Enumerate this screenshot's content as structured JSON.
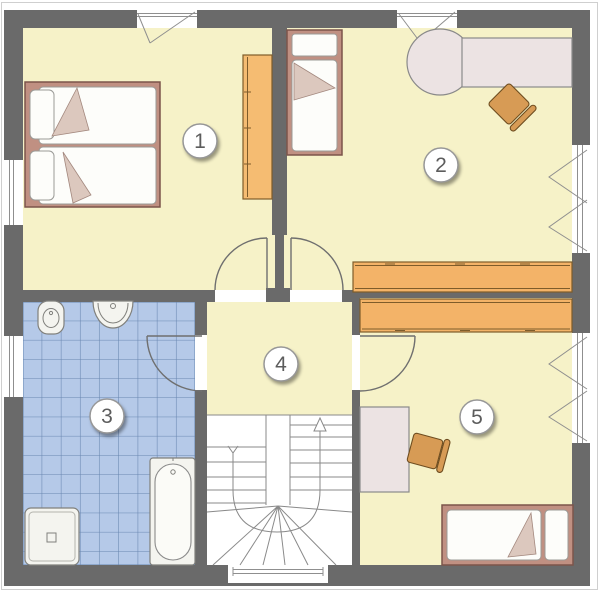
{
  "plan": {
    "kind": "floor-plan",
    "rooms": [
      {
        "badge": "1"
      },
      {
        "badge": "2"
      },
      {
        "badge": "3"
      },
      {
        "badge": "4"
      },
      {
        "badge": "5"
      }
    ],
    "colors": {
      "wall": "#6a6a6a",
      "floor": "#f6f2c8",
      "bath_tile": "#b5c9e8",
      "bath_tile_line": "#6886b0",
      "wood_orange": "#f3b368",
      "bed_frame_rose": "#c09082",
      "desk_gray": "#ece3e3",
      "chair_orange": "#d79b55",
      "fixture_white": "#f4f4ef"
    }
  }
}
